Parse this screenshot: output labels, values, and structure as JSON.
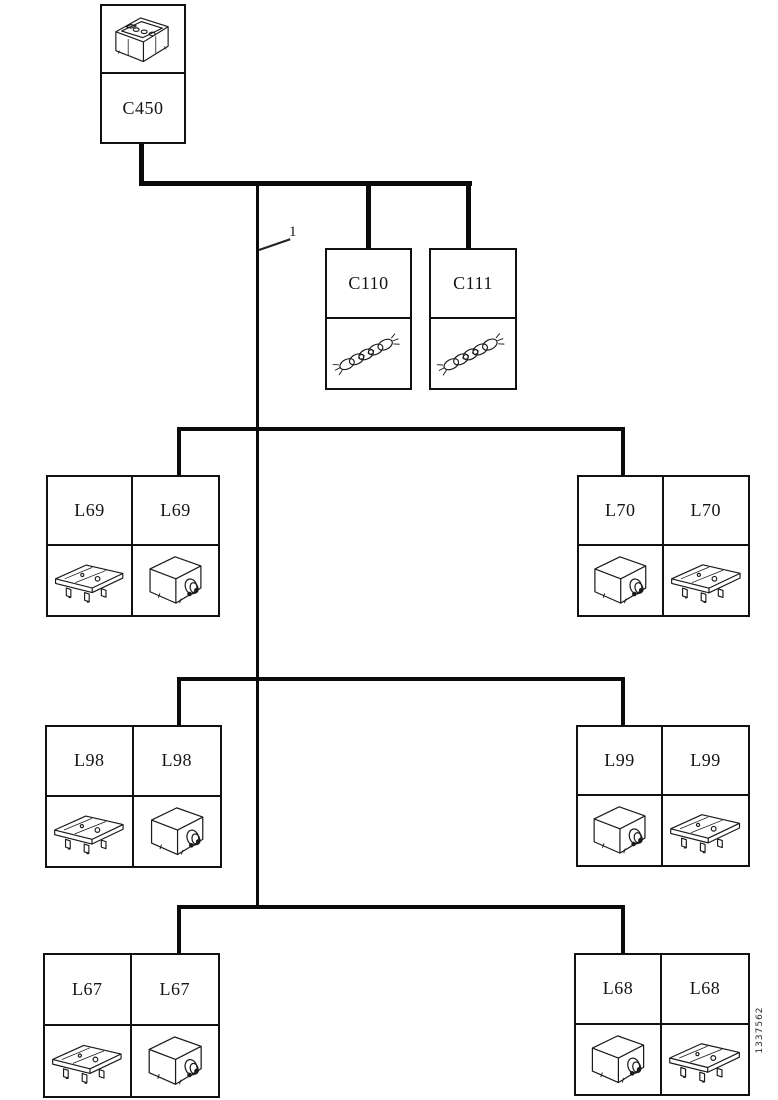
{
  "diagram": {
    "figure_number": "1337562",
    "callout": {
      "label": "1"
    },
    "colors": {
      "line": "#0a0a0a",
      "background": "#ffffff",
      "text": "#141414"
    },
    "c450": {
      "label": "C450",
      "icon": "battery-icon"
    },
    "connectors": {
      "c110": {
        "label": "C110",
        "icon": "braided-strap-icon"
      },
      "c111": {
        "label": "C111",
        "icon": "braided-strap-icon"
      }
    },
    "groups": {
      "l69": {
        "left": {
          "label": "L69",
          "icon": "bracket-lamp-icon"
        },
        "right": {
          "label": "L69",
          "icon": "lamp-unit-icon"
        }
      },
      "l70": {
        "left": {
          "label": "L70",
          "icon": "lamp-unit-icon"
        },
        "right": {
          "label": "L70",
          "icon": "bracket-lamp-icon"
        }
      },
      "l98": {
        "left": {
          "label": "L98",
          "icon": "bracket-lamp-icon"
        },
        "right": {
          "label": "L98",
          "icon": "lamp-unit-icon"
        }
      },
      "l99": {
        "left": {
          "label": "L99",
          "icon": "lamp-unit-icon"
        },
        "right": {
          "label": "L99",
          "icon": "bracket-lamp-icon"
        }
      },
      "l67": {
        "left": {
          "label": "L67",
          "icon": "bracket-lamp-icon"
        },
        "right": {
          "label": "L67",
          "icon": "lamp-unit-icon"
        }
      },
      "l68": {
        "left": {
          "label": "L68",
          "icon": "lamp-unit-icon"
        },
        "right": {
          "label": "L68",
          "icon": "bracket-lamp-icon"
        }
      }
    }
  }
}
